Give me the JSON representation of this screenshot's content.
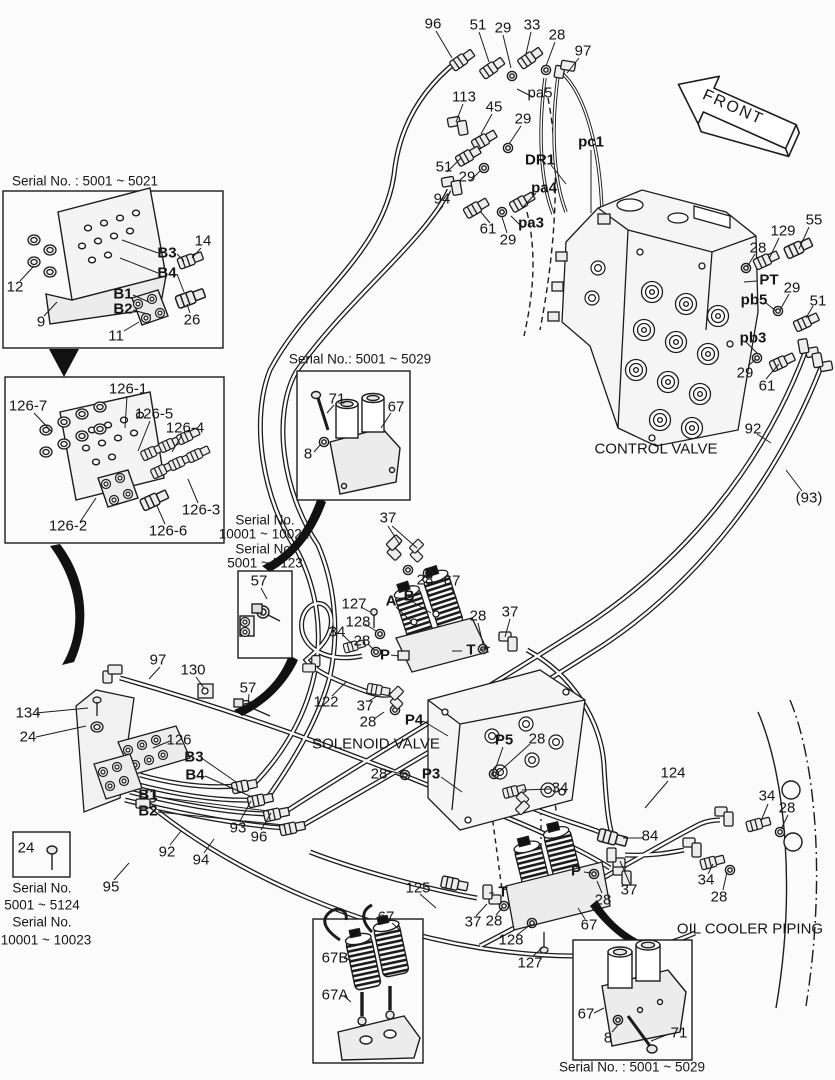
{
  "canvas": {
    "width": 835,
    "height": 1080,
    "background": "#fbfbfb",
    "ink": "#1c1c1c"
  },
  "labels": [
    {
      "t": "96",
      "x": 433,
      "y": 24
    },
    {
      "t": "51",
      "x": 478,
      "y": 25
    },
    {
      "t": "29",
      "x": 503,
      "y": 28
    },
    {
      "t": "33",
      "x": 532,
      "y": 25
    },
    {
      "t": "28",
      "x": 557,
      "y": 35
    },
    {
      "t": "97",
      "x": 583,
      "y": 51
    },
    {
      "t": "pa5",
      "x": 540,
      "y": 93
    },
    {
      "t": "113",
      "x": 464,
      "y": 97
    },
    {
      "t": "45",
      "x": 494,
      "y": 107
    },
    {
      "t": "29",
      "x": 523,
      "y": 119
    },
    {
      "t": "DR1",
      "x": 540,
      "y": 160,
      "b": 1
    },
    {
      "t": "pc1",
      "x": 591,
      "y": 142,
      "b": 1
    },
    {
      "t": "51",
      "x": 444,
      "y": 167
    },
    {
      "t": "29",
      "x": 467,
      "y": 177
    },
    {
      "t": "pa4",
      "x": 544,
      "y": 188,
      "b": 1
    },
    {
      "t": "94",
      "x": 442,
      "y": 199
    },
    {
      "t": "61",
      "x": 488,
      "y": 229
    },
    {
      "t": "pa3",
      "x": 531,
      "y": 223,
      "b": 1
    },
    {
      "t": "29",
      "x": 508,
      "y": 240
    },
    {
      "t": "FRONT",
      "x": 733,
      "y": 108,
      "r": 24,
      "ls": 2,
      "s": 16
    },
    {
      "t": "28",
      "x": 758,
      "y": 248
    },
    {
      "t": "129",
      "x": 783,
      "y": 231
    },
    {
      "t": "55",
      "x": 814,
      "y": 220
    },
    {
      "t": "PT",
      "x": 769,
      "y": 280,
      "b": 1
    },
    {
      "t": "pb5",
      "x": 754,
      "y": 300,
      "b": 1
    },
    {
      "t": "29",
      "x": 792,
      "y": 288
    },
    {
      "t": "51",
      "x": 818,
      "y": 301
    },
    {
      "t": "pb3",
      "x": 753,
      "y": 338,
      "b": 1
    },
    {
      "t": "29",
      "x": 745,
      "y": 373
    },
    {
      "t": "61",
      "x": 767,
      "y": 386
    },
    {
      "t": "92",
      "x": 753,
      "y": 429
    },
    {
      "t": "(93)",
      "x": 809,
      "y": 498
    },
    {
      "t": "CONTROL VALVE",
      "x": 656,
      "y": 449
    },
    {
      "t": "Serial No. : 5001 ~ 5021",
      "x": 85,
      "y": 181,
      "s": 13.5
    },
    {
      "t": "12",
      "x": 15,
      "y": 287
    },
    {
      "t": "9",
      "x": 41,
      "y": 322
    },
    {
      "t": "11",
      "x": 116,
      "y": 336
    },
    {
      "t": "B1",
      "x": 123,
      "y": 294,
      "b": 1
    },
    {
      "t": "B2",
      "x": 123,
      "y": 309,
      "b": 1
    },
    {
      "t": "B3",
      "x": 167,
      "y": 253,
      "b": 1
    },
    {
      "t": "B4",
      "x": 167,
      "y": 273,
      "b": 1
    },
    {
      "t": "14",
      "x": 203,
      "y": 241
    },
    {
      "t": "26",
      "x": 192,
      "y": 320
    },
    {
      "t": "126-1",
      "x": 128,
      "y": 389
    },
    {
      "t": "126-7",
      "x": 28,
      "y": 406
    },
    {
      "t": "126-5",
      "x": 154,
      "y": 414
    },
    {
      "t": "126-4",
      "x": 185,
      "y": 428
    },
    {
      "t": "126-3",
      "x": 201,
      "y": 510
    },
    {
      "t": "126-2",
      "x": 68,
      "y": 526
    },
    {
      "t": "126-6",
      "x": 168,
      "y": 531
    },
    {
      "t": "Serial No.: 5001 ~ 5029",
      "x": 360,
      "y": 359,
      "s": 13.5
    },
    {
      "t": "71",
      "x": 337,
      "y": 399
    },
    {
      "t": "67",
      "x": 396,
      "y": 407
    },
    {
      "t": "8",
      "x": 308,
      "y": 454
    },
    {
      "t": "Serial No.",
      "x": 265,
      "y": 520,
      "s": 13.5
    },
    {
      "t": "10001 ~ 10022",
      "x": 264,
      "y": 534,
      "s": 13.5
    },
    {
      "t": "Serial No.",
      "x": 265,
      "y": 549,
      "s": 13.5
    },
    {
      "t": "5001 ~ 5123",
      "x": 265,
      "y": 563,
      "s": 13.5
    },
    {
      "t": "57",
      "x": 259,
      "y": 581
    },
    {
      "t": "37",
      "x": 388,
      "y": 518
    },
    {
      "t": "28",
      "x": 425,
      "y": 580
    },
    {
      "t": "67",
      "x": 452,
      "y": 581
    },
    {
      "t": "A",
      "x": 391,
      "y": 601,
      "b": 1
    },
    {
      "t": "B",
      "x": 409,
      "y": 596,
      "b": 1
    },
    {
      "t": "127",
      "x": 354,
      "y": 604
    },
    {
      "t": "128",
      "x": 358,
      "y": 622
    },
    {
      "t": "34",
      "x": 337,
      "y": 632
    },
    {
      "t": "28",
      "x": 362,
      "y": 641
    },
    {
      "t": "P",
      "x": 385,
      "y": 655,
      "b": 1
    },
    {
      "t": "28",
      "x": 478,
      "y": 616
    },
    {
      "t": "37",
      "x": 510,
      "y": 612
    },
    {
      "t": "T",
      "x": 471,
      "y": 650,
      "b": 1
    },
    {
      "t": "122",
      "x": 326,
      "y": 702
    },
    {
      "t": "37",
      "x": 365,
      "y": 706
    },
    {
      "t": "28",
      "x": 368,
      "y": 722
    },
    {
      "t": "P4",
      "x": 414,
      "y": 720,
      "b": 1
    },
    {
      "t": "SOLENOID VALVE",
      "x": 376,
      "y": 744
    },
    {
      "t": "P5",
      "x": 504,
      "y": 740,
      "b": 1
    },
    {
      "t": "28",
      "x": 537,
      "y": 739
    },
    {
      "t": "28",
      "x": 379,
      "y": 774
    },
    {
      "t": "P3",
      "x": 431,
      "y": 774,
      "b": 1
    },
    {
      "t": "34",
      "x": 560,
      "y": 788
    },
    {
      "t": "97",
      "x": 158,
      "y": 660
    },
    {
      "t": "130",
      "x": 193,
      "y": 670
    },
    {
      "t": "57",
      "x": 248,
      "y": 688
    },
    {
      "t": "134",
      "x": 28,
      "y": 713
    },
    {
      "t": "24",
      "x": 28,
      "y": 737
    },
    {
      "t": "126",
      "x": 179,
      "y": 740
    },
    {
      "t": "B3",
      "x": 194,
      "y": 757,
      "b": 1
    },
    {
      "t": "B4",
      "x": 195,
      "y": 775,
      "b": 1
    },
    {
      "t": "B1",
      "x": 148,
      "y": 795,
      "b": 1
    },
    {
      "t": "B2",
      "x": 148,
      "y": 811,
      "b": 1
    },
    {
      "t": "93",
      "x": 238,
      "y": 828
    },
    {
      "t": "96",
      "x": 259,
      "y": 837
    },
    {
      "t": "92",
      "x": 167,
      "y": 852
    },
    {
      "t": "94",
      "x": 201,
      "y": 860
    },
    {
      "t": "95",
      "x": 111,
      "y": 887
    },
    {
      "t": "24",
      "x": 26,
      "y": 848
    },
    {
      "t": "Serial No.",
      "x": 42,
      "y": 888,
      "s": 13.5
    },
    {
      "t": "5001 ~ 5124",
      "x": 42,
      "y": 905,
      "s": 13.5
    },
    {
      "t": "Serial No.",
      "x": 42,
      "y": 922,
      "s": 13.5
    },
    {
      "t": "10001 ~ 10023",
      "x": 46,
      "y": 940,
      "s": 13.5
    },
    {
      "t": "124",
      "x": 673,
      "y": 773
    },
    {
      "t": "34",
      "x": 767,
      "y": 796
    },
    {
      "t": "28",
      "x": 787,
      "y": 808
    },
    {
      "t": "84",
      "x": 650,
      "y": 836
    },
    {
      "t": "34",
      "x": 706,
      "y": 880
    },
    {
      "t": "37",
      "x": 629,
      "y": 890
    },
    {
      "t": "28",
      "x": 719,
      "y": 897
    },
    {
      "t": "OIL COOLER PIPING",
      "x": 750,
      "y": 929
    },
    {
      "t": "125",
      "x": 418,
      "y": 888
    },
    {
      "t": "T",
      "x": 503,
      "y": 892,
      "b": 1
    },
    {
      "t": "37",
      "x": 473,
      "y": 922
    },
    {
      "t": "28",
      "x": 494,
      "y": 921
    },
    {
      "t": "128",
      "x": 511,
      "y": 940
    },
    {
      "t": "127",
      "x": 530,
      "y": 963
    },
    {
      "t": "P",
      "x": 576,
      "y": 871,
      "b": 1
    },
    {
      "t": "28",
      "x": 603,
      "y": 900
    },
    {
      "t": "67",
      "x": 589,
      "y": 925
    },
    {
      "t": "67",
      "x": 386,
      "y": 917
    },
    {
      "t": "67B",
      "x": 335,
      "y": 958
    },
    {
      "t": "67A",
      "x": 335,
      "y": 995
    },
    {
      "t": "67",
      "x": 586,
      "y": 1014
    },
    {
      "t": "8",
      "x": 608,
      "y": 1038
    },
    {
      "t": "71",
      "x": 679,
      "y": 1033
    },
    {
      "t": "Serial No. : 5001 ~ 5029",
      "x": 632,
      "y": 1067,
      "s": 13.5
    }
  ]
}
